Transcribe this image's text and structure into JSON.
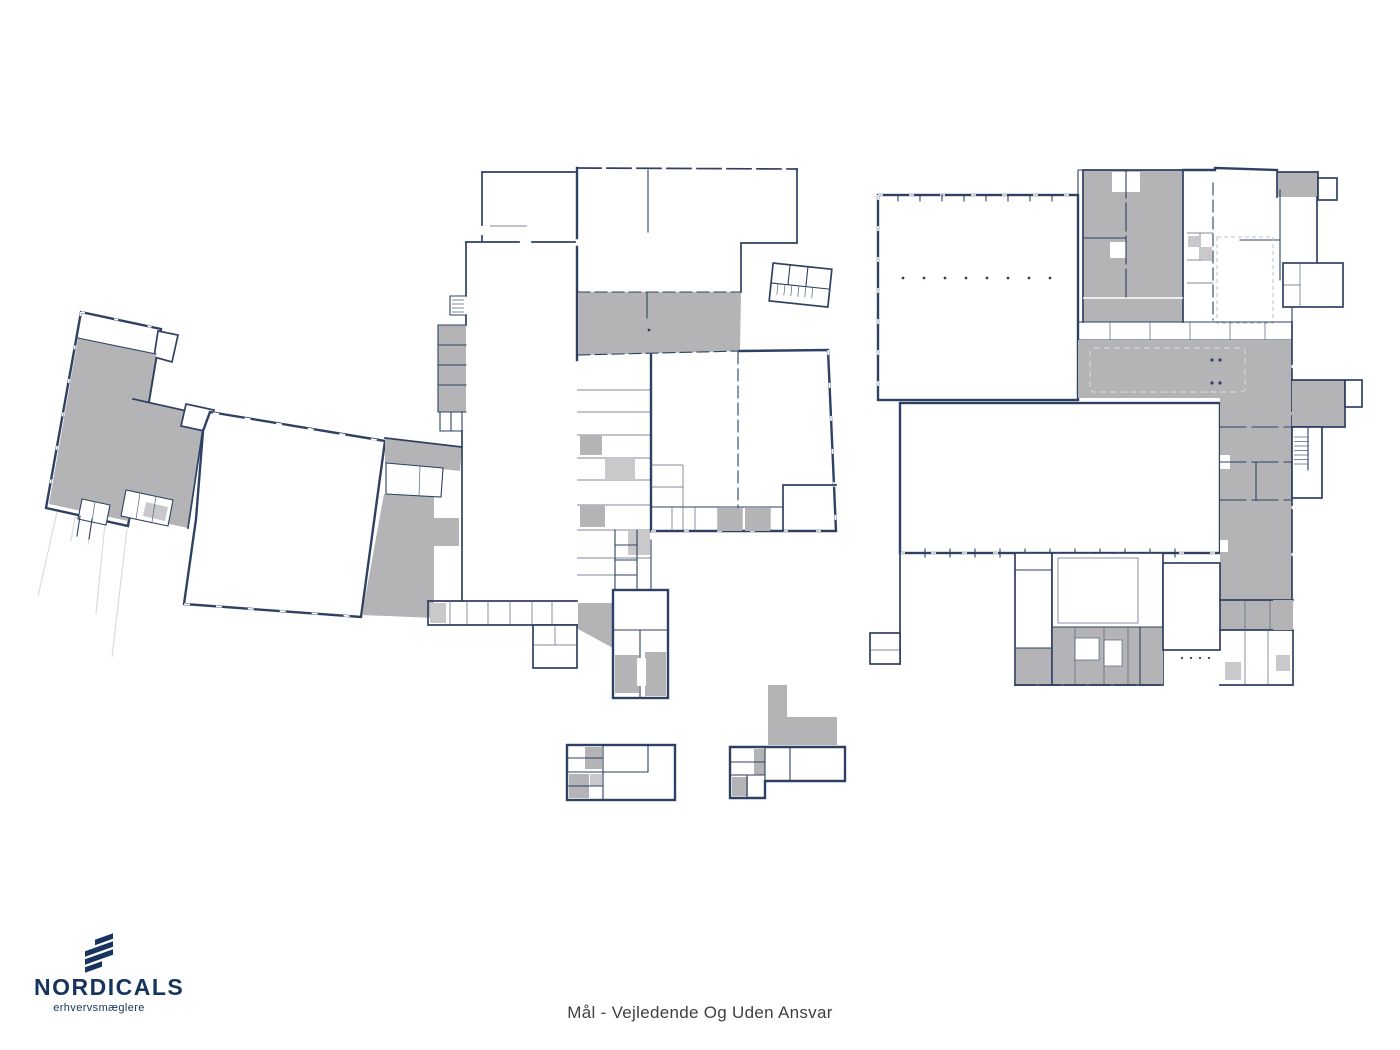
{
  "branding": {
    "name": "NORDICALS",
    "tagline": "erhvervsmæglere",
    "brand_color": "#16345c"
  },
  "caption": {
    "text": "Mål - Vejledende Og Uden Ansvar",
    "color": "#3f3f3f"
  },
  "colors": {
    "background": "#ffffff",
    "wall": "#2e4163",
    "room_fill_gray": "#b4b4b7",
    "room_fill_light_gray": "#c9c9cc",
    "faint_line": "#dcdcde"
  }
}
